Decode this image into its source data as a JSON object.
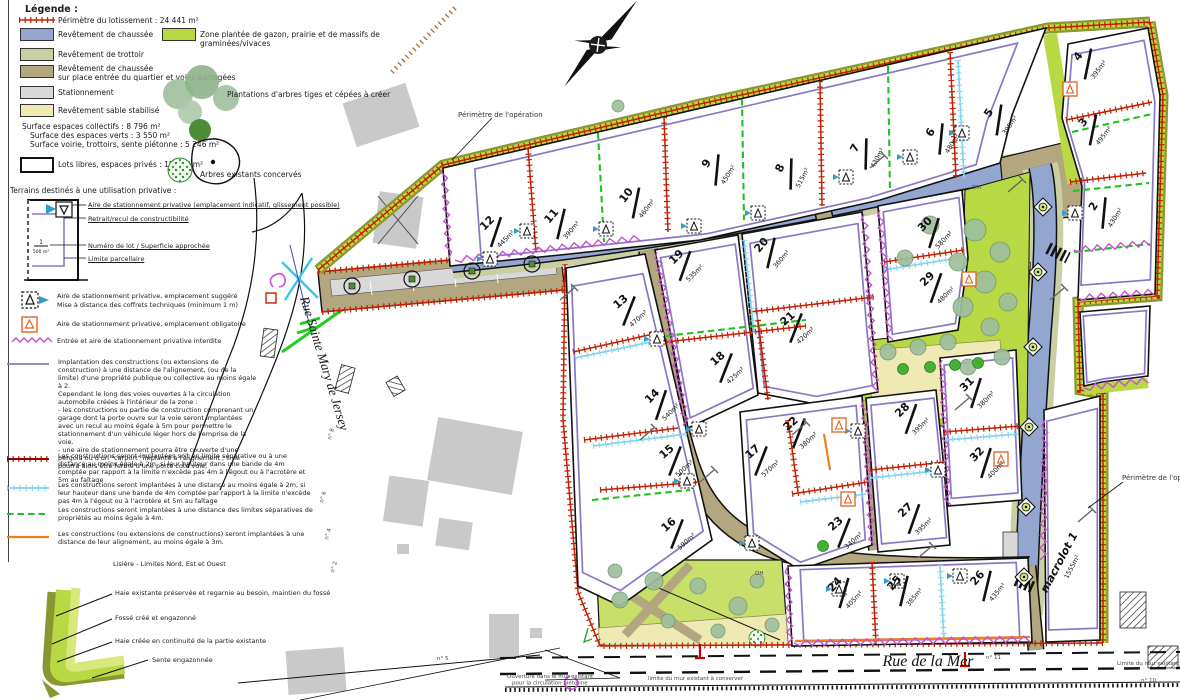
{
  "legend": {
    "title": "Légende :",
    "perimeter_label": "Périmètre du lotissement : 24 441 m²",
    "surfaces": [
      {
        "label": "Revêtement de chaussée"
      },
      {
        "label": "Revêtement de trottoir"
      },
      {
        "label": "Revêtement de chaussée",
        "label2": "sur place entrée du quartier et voies partagées"
      },
      {
        "label": "Stationnement"
      },
      {
        "label": "Revêtement sable stabilisé"
      }
    ],
    "green_zone_label": "Zone plantée de gazon, prairie et de massifs de graminées/vivaces",
    "trees_create_label": "Plantations d'arbres tiges et cépées à créer",
    "trees_existing_label": "Arbres existants concervés",
    "stats": [
      "Surface espaces collectifs : 8 796 m²",
      "Surface des espaces verts : 3 550 m²",
      "Surface voirie, trottoirs, sente piétonne : 5 246 m²"
    ],
    "lots_free_label": "Lots libres, espaces privés : 15 645 m²",
    "private_title": "Terrains destinés à une utilisation privative :",
    "lot_diagram": {
      "callout1": "Aire de stationnement privative (emplacement indicatif, glissement possible)",
      "callout2": "Retrait/recul de constructibilité",
      "callout3": "Numéro de lot / Superficie approchée",
      "callout4": "Limite parcellaire",
      "num": "1",
      "area": "500 m²"
    },
    "symbol_suggested": "Aire de stationnement privative, emplacement suggéré",
    "symbol_suggested2": "Mise à distance des coffrets techniques (minimum 1 m)",
    "symbol_required": "Aire de stationnement privative, emplacement obligatoire",
    "symbol_forbidden": "Entrée et aire de stationnement privative interdite",
    "rules": [
      {
        "text": "Implantation des constructions (ou extensions de construction) à une distance de l'alignement, (ou de la limite) d'une propriété publique ou collective au moins égale à 2.\nCependant le long des voies ouvertes à la circulation automobile créées à l'intérieur de la zone :\n- les constructions ou partie de construction comprenant un garage dont la porte ouvre sur la voie seront implantées avec un recul au moins égale à 5m pour permettre le stationnement d'un véhicule léger hors de l'emprise de la voie.\n- une aire de stationnement pourra être couverte d'une pergola ou d'un \"carport\" implanté à l'alignement ; il ne pourra alors être fermé d'une porte coté voie;"
      },
      {
        "text": "Les constructions seront implantées soit en limite séparative ou à une distance au moins égale à 2m, si leur hauteur dans une bande de 4m comptée par rapport à la limite n'excède pas 4m à l'égout ou à l'acrotère et 5m au faîtage"
      },
      {
        "text": "Les constructions seront implantées à une distance au moins égale à 2m, si leur hauteur dans une bande de 4m comptée par rapport à la limite n'excède pas 4m à l'égout ou à l'acrotère et 5m au faîtage"
      },
      {
        "text": "Les constructions seront implantées à une distance des limites séparatives de propriétés au moins égale à 4m."
      },
      {
        "text": "Les constructions (ou extensions de constructions) seront implantées à une distance de leur alignement, au moins égale à 3m."
      }
    ],
    "lisere_title": "Lisière - Limites Nord, Est et Ouest",
    "lisere": [
      "Haie existante préservée et regarnie au besoin, maintien du fossé",
      "Fossé créé et engazonné",
      "Haie créée en continuité de la partie existante",
      "Sente engazonnée"
    ]
  },
  "map": {
    "labels": {
      "perimetre_op_1": "Périmètre de l'opération",
      "perimetre_op_2": "Périmètre de l'opération",
      "rue_sainte": "Rue Sainte Mary de Jersey",
      "rue_mer": "Rue de la Mer",
      "wall_left": "Ouverture dans le mur existant\npour la circulation piétonne",
      "wall_center": "limite du mur existant à conserver",
      "wall_right": "Limite du mur existant à conserver"
    },
    "small_labels": [
      {
        "t": "DM",
        "x": 972,
        "y": 189,
        "r": 0
      },
      {
        "t": "OH",
        "x": 755,
        "y": 575,
        "r": 0
      },
      {
        "t": "n° 8",
        "x": 331,
        "y": 440,
        "r": -75
      },
      {
        "t": "n° 6",
        "x": 323,
        "y": 503,
        "r": -75
      },
      {
        "t": "n° 4",
        "x": 328,
        "y": 540,
        "r": -75
      },
      {
        "t": "n° 2",
        "x": 334,
        "y": 573,
        "r": -75
      },
      {
        "t": "n° 5",
        "x": 437,
        "y": 660,
        "r": 0
      },
      {
        "t": "n° 11",
        "x": 986,
        "y": 659,
        "r": 0
      },
      {
        "t": "n° 10",
        "x": 1141,
        "y": 682,
        "r": 0
      }
    ],
    "lots": [
      {
        "n": "12",
        "area": "445m²",
        "x": 496,
        "y": 232,
        "r": -45
      },
      {
        "n": "11",
        "area": "390m²",
        "x": 561,
        "y": 224,
        "r": -50
      },
      {
        "n": "10",
        "area": "460m²",
        "x": 636,
        "y": 203,
        "r": -52
      },
      {
        "n": "9",
        "area": "450m²",
        "x": 717,
        "y": 170,
        "r": -58
      },
      {
        "n": "8",
        "area": "515m²",
        "x": 791,
        "y": 174,
        "r": -62
      },
      {
        "n": "7",
        "area": "430m²",
        "x": 866,
        "y": 154,
        "r": -62
      },
      {
        "n": "6",
        "area": "480m²",
        "x": 941,
        "y": 139,
        "r": -58
      },
      {
        "n": "5",
        "area": "395m²",
        "x": 999,
        "y": 120,
        "r": -55
      },
      {
        "n": "4",
        "area": "395m²",
        "x": 1088,
        "y": 64,
        "r": -52
      },
      {
        "n": "3",
        "area": "495m²",
        "x": 1093,
        "y": 130,
        "r": -52
      },
      {
        "n": "2",
        "area": "430m²",
        "x": 1104,
        "y": 213,
        "r": -58
      },
      {
        "n": "13",
        "area": "470m²",
        "x": 629,
        "y": 311,
        "r": -42
      },
      {
        "n": "14",
        "area": "540m²",
        "x": 661,
        "y": 405,
        "r": -45
      },
      {
        "n": "15",
        "area": "500m²",
        "x": 675,
        "y": 461,
        "r": -42
      },
      {
        "n": "16",
        "area": "590m²",
        "x": 677,
        "y": 534,
        "r": -42
      },
      {
        "n": "17",
        "area": "570m²",
        "x": 761,
        "y": 461,
        "r": -42
      },
      {
        "n": "18",
        "area": "425m²",
        "x": 726,
        "y": 368,
        "r": -42
      },
      {
        "n": "19",
        "area": "535m²",
        "x": 685,
        "y": 266,
        "r": -44
      },
      {
        "n": "20",
        "area": "360m²",
        "x": 771,
        "y": 253,
        "r": -50
      },
      {
        "n": "21",
        "area": "420m²",
        "x": 796,
        "y": 328,
        "r": -42
      },
      {
        "n": "22",
        "area": "380m²",
        "x": 799,
        "y": 433,
        "r": -42
      },
      {
        "n": "23",
        "area": "340m²",
        "x": 844,
        "y": 533,
        "r": -42
      },
      {
        "n": "24",
        "area": "405m²",
        "x": 844,
        "y": 593,
        "r": -47
      },
      {
        "n": "25",
        "area": "385m²",
        "x": 904,
        "y": 591,
        "r": -50
      },
      {
        "n": "26",
        "area": "435m²",
        "x": 987,
        "y": 586,
        "r": -50
      },
      {
        "n": "27",
        "area": "395m²",
        "x": 914,
        "y": 519,
        "r": -44
      },
      {
        "n": "28",
        "area": "395m²",
        "x": 911,
        "y": 419,
        "r": -44
      },
      {
        "n": "29",
        "area": "480m²",
        "x": 936,
        "y": 288,
        "r": -44
      },
      {
        "n": "30",
        "area": "580m²",
        "x": 934,
        "y": 233,
        "r": -46
      },
      {
        "n": "31",
        "area": "380m²",
        "x": 976,
        "y": 393,
        "r": -46
      },
      {
        "n": "32",
        "area": "400m²",
        "x": 986,
        "y": 463,
        "r": -46
      },
      {
        "n": "macrolot 1",
        "area": "1555m²",
        "x": 1064,
        "y": 565,
        "r": -62,
        "m": true
      }
    ],
    "parking_suggested": [
      [
        527,
        231
      ],
      [
        606,
        229
      ],
      [
        694,
        226
      ],
      [
        846,
        177
      ],
      [
        910,
        157
      ],
      [
        962,
        133
      ],
      [
        1075,
        213
      ],
      [
        657,
        339
      ],
      [
        699,
        429
      ],
      [
        687,
        481
      ],
      [
        858,
        431
      ],
      [
        938,
        470
      ],
      [
        897,
        581
      ],
      [
        839,
        589
      ],
      [
        752,
        543
      ],
      [
        960,
        576
      ],
      [
        490,
        259
      ],
      [
        758,
        213
      ]
    ],
    "parking_required": [
      [
        1070,
        89
      ],
      [
        969,
        279
      ],
      [
        839,
        425
      ],
      [
        848,
        499
      ],
      [
        1001,
        459
      ]
    ],
    "colors": {
      "road_blue": "#93a6cf",
      "sidewalk": "#c9cfa3",
      "shared_road": "#b3a780",
      "parking_gray": "#d9d9d9",
      "sand": "#efe9b4",
      "planted_green": "#b8d943",
      "hedge_olive": "#8a9630",
      "perimeter_red": "#c22000",
      "parcel_purple": "#8878c3",
      "forbidden_magenta": "#c84fd0"
    }
  }
}
